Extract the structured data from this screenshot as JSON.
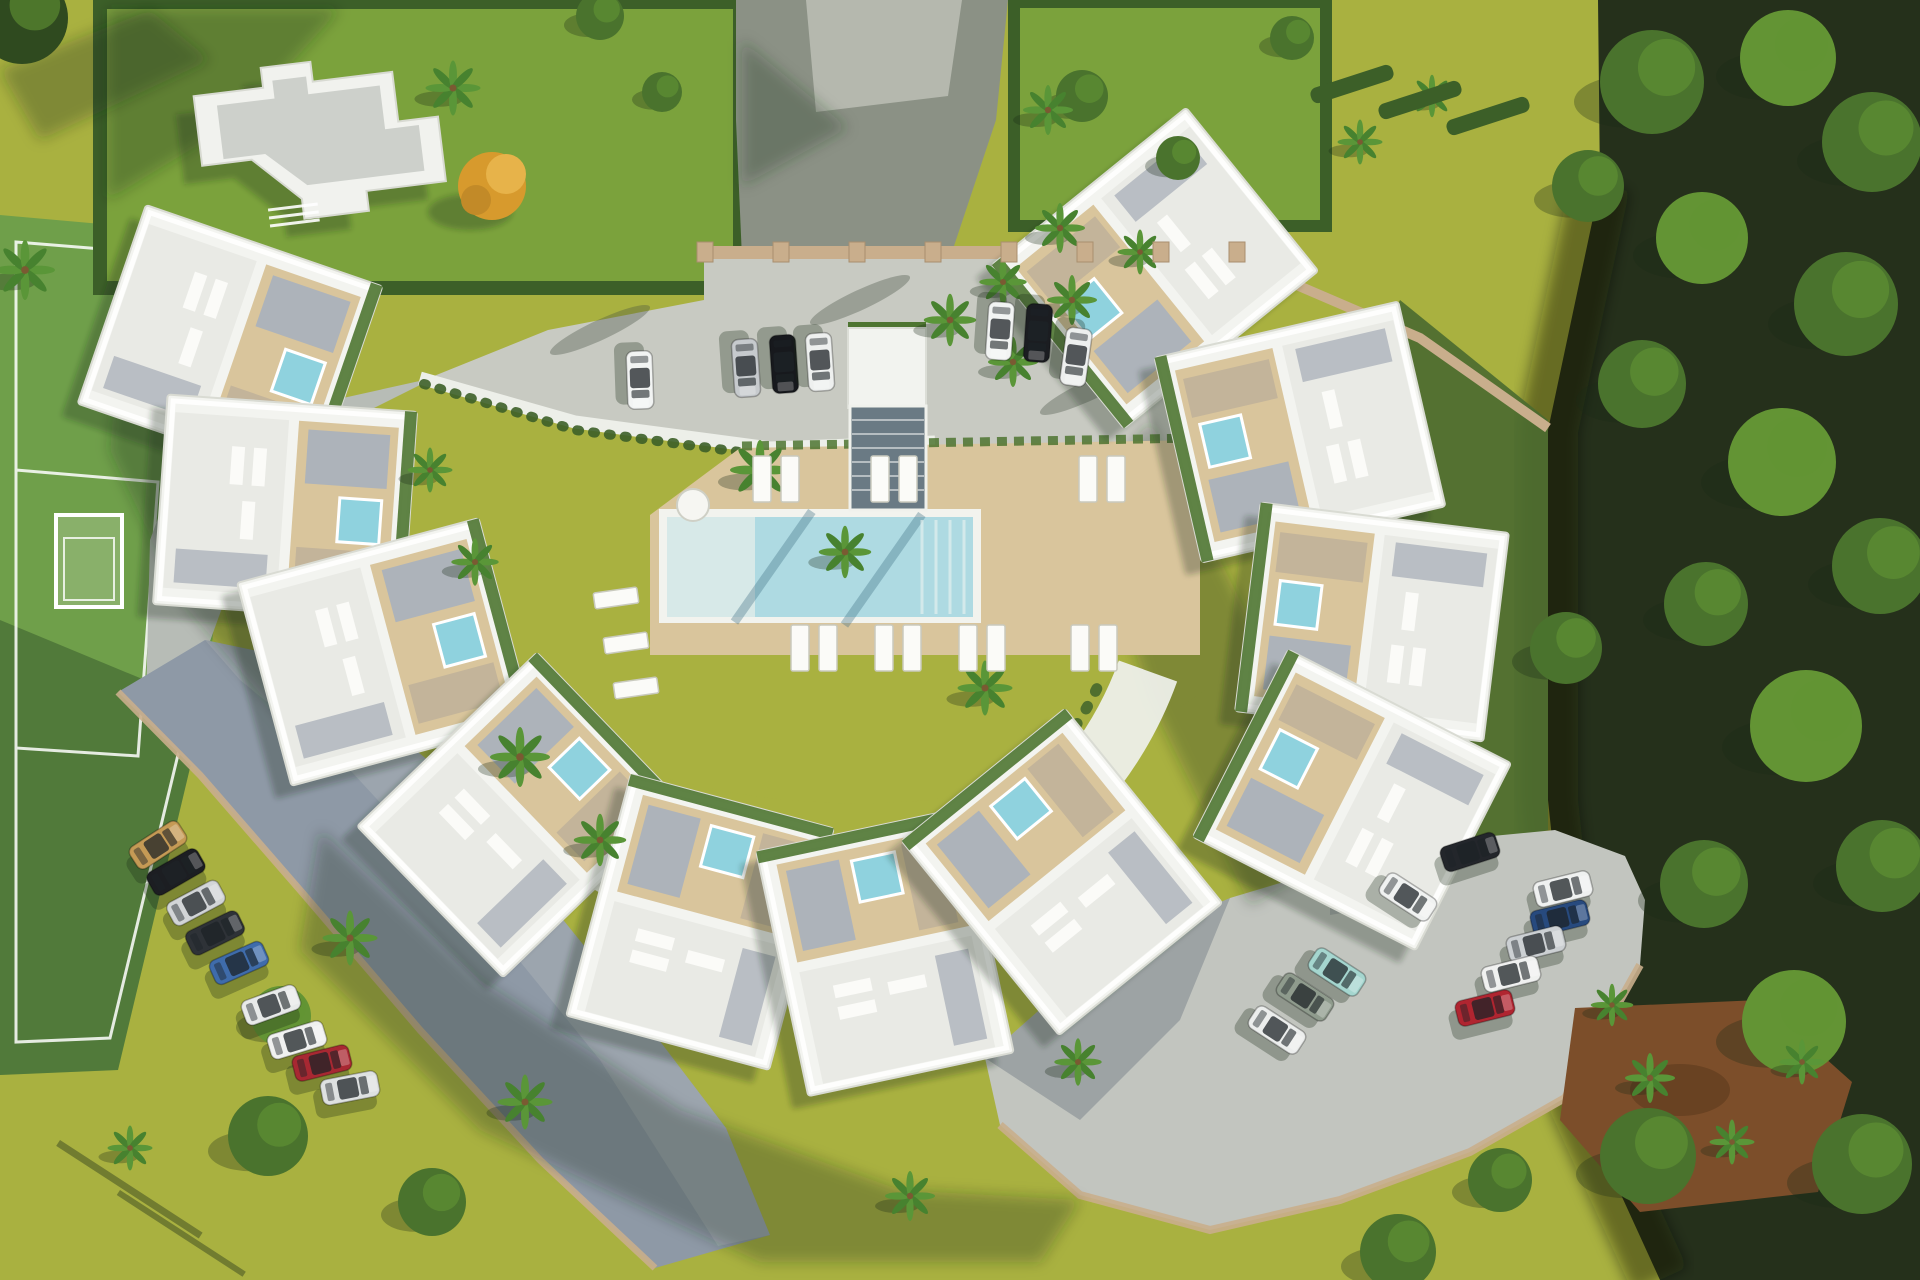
{
  "scene": {
    "description": "Aerial 3D architectural rendering of a crescent-shaped white apartment complex with rooftop terraces and plunge pools, a central lawn with rectangular swimming pool and timber sun deck, surrounding parking areas with cars, a green sports pitch on the left, a detached villa in a hedged garden at top-left, and dense dark woodland along the right side",
    "palette": {
      "grass": "#a9b140",
      "grass_bright": "#b8bf4e",
      "grass_dark": "#7ba23c",
      "pitch": "#6f9f4a",
      "hedge": "#3c5f28",
      "forest_bg": "#25301b",
      "forest_tree": "#4a732d",
      "forest_tree_light": "#639434",
      "forest_tree_dark": "#2f4a1f",
      "asphalt": "#8b9185",
      "concrete": "#c8cac2",
      "concrete_pad": "#b9bdb2",
      "concrete_lower": "#c2c5bf",
      "parking_shadow": "#8e99a6",
      "path": "#b7bcb6",
      "wall": "#c9ae8c",
      "building": "#f3f4f0",
      "roof_light": "#e9eae5",
      "roof_gray": "#cdd0cb",
      "deck": "#d9c59c",
      "gravel": "#adb3ba",
      "jacuzzi": "#8fd2de",
      "pool": "#aedae2",
      "pool_shallow": "#d7e9e8",
      "pool_rim": "#f2f3ee",
      "pergola": "#6a7a84",
      "dirt": "#7c4e2a",
      "mulch": "#8a4f2e",
      "lounger": "#fbfbf8",
      "shadow": "rgba(28,42,24,0.30)"
    },
    "units": [
      {
        "x": 230,
        "y": 345,
        "r": 109
      },
      {
        "x": 285,
        "y": 508,
        "r": 94
      },
      {
        "x": 385,
        "y": 652,
        "r": 75
      },
      {
        "x": 520,
        "y": 815,
        "r": 46
      },
      {
        "x": 700,
        "y": 922,
        "r": 15
      },
      {
        "x": 885,
        "y": 952,
        "r": -12
      },
      {
        "x": 1062,
        "y": 872,
        "r": -39
      },
      {
        "x": 1155,
        "y": 268,
        "r": -129
      },
      {
        "x": 1300,
        "y": 432,
        "r": -103
      },
      {
        "x": 1372,
        "y": 622,
        "r": -83
      },
      {
        "x": 1352,
        "y": 800,
        "r": -63
      }
    ],
    "cars": [
      {
        "x": 640,
        "y": 380,
        "a": 88,
        "c": "#f2f4f3"
      },
      {
        "x": 746,
        "y": 368,
        "a": 86,
        "c": "#c6cacd"
      },
      {
        "x": 784,
        "y": 364,
        "a": 86,
        "c": "#17191d"
      },
      {
        "x": 820,
        "y": 362,
        "a": 86,
        "c": "#eef0ef"
      },
      {
        "x": 1000,
        "y": 331,
        "a": 94,
        "c": "#f2f4f3"
      },
      {
        "x": 1038,
        "y": 333,
        "a": 94,
        "c": "#1b1d21"
      },
      {
        "x": 1076,
        "y": 357,
        "a": 98,
        "c": "#edefee"
      },
      {
        "x": 158,
        "y": 845,
        "a": -33,
        "c": "#c59a55"
      },
      {
        "x": 176,
        "y": 872,
        "a": -30,
        "c": "#1c1e22"
      },
      {
        "x": 196,
        "y": 903,
        "a": -28,
        "c": "#d2d5d7"
      },
      {
        "x": 215,
        "y": 933,
        "a": -26,
        "c": "#2e3237"
      },
      {
        "x": 239,
        "y": 963,
        "a": -24,
        "c": "#3f6cab"
      },
      {
        "x": 271,
        "y": 1005,
        "a": -20,
        "c": "#e8eae9"
      },
      {
        "x": 297,
        "y": 1040,
        "a": -17,
        "c": "#f0f1f0"
      },
      {
        "x": 322,
        "y": 1063,
        "a": -14,
        "c": "#a82832"
      },
      {
        "x": 350,
        "y": 1088,
        "a": -11,
        "c": "#dee1e1"
      },
      {
        "x": 1408,
        "y": 897,
        "a": 33,
        "c": "#f0f2f1"
      },
      {
        "x": 1337,
        "y": 972,
        "a": 33,
        "c": "#a5d6cf"
      },
      {
        "x": 1305,
        "y": 997,
        "a": 33,
        "c": "#8f9b8d"
      },
      {
        "x": 1277,
        "y": 1030,
        "a": 33,
        "c": "#eceeed"
      },
      {
        "x": 1470,
        "y": 852,
        "a": -18,
        "c": "#23262b"
      },
      {
        "x": 1563,
        "y": 889,
        "a": -14,
        "c": "#eff1f0"
      },
      {
        "x": 1560,
        "y": 918,
        "a": -14,
        "c": "#274a7e"
      },
      {
        "x": 1536,
        "y": 944,
        "a": -14,
        "c": "#ccd0d3"
      },
      {
        "x": 1511,
        "y": 974,
        "a": -14,
        "c": "#f0f1f0"
      },
      {
        "x": 1485,
        "y": 1008,
        "a": -14,
        "c": "#b02530"
      }
    ],
    "palms": [
      [
        453,
        88,
        1.1
      ],
      [
        25,
        270,
        1.2
      ],
      [
        1048,
        110,
        1.0
      ],
      [
        1060,
        228,
        1.0
      ],
      [
        1013,
        362,
        1.0
      ],
      [
        950,
        320,
        1.05
      ],
      [
        1003,
        282,
        0.95
      ],
      [
        1072,
        300,
        1.0
      ],
      [
        1140,
        252,
        0.9
      ],
      [
        760,
        470,
        1.2
      ],
      [
        845,
        552,
        1.05
      ],
      [
        985,
        688,
        1.1
      ],
      [
        520,
        757,
        1.2
      ],
      [
        600,
        840,
        1.05
      ],
      [
        475,
        562,
        0.95
      ],
      [
        430,
        470,
        0.9
      ],
      [
        350,
        938,
        1.1
      ],
      [
        525,
        1102,
        1.1
      ],
      [
        910,
        1196,
        1.0
      ],
      [
        1078,
        1062,
        0.95
      ],
      [
        1650,
        1078,
        1.0
      ],
      [
        1732,
        1142,
        0.9
      ],
      [
        1802,
        1062,
        0.9
      ],
      [
        1612,
        1005,
        0.85
      ],
      [
        1360,
        142,
        0.9
      ],
      [
        1432,
        96,
        0.85
      ],
      [
        130,
        1148,
        0.9
      ]
    ],
    "trees": [
      [
        22,
        18,
        46,
        2
      ],
      [
        600,
        16,
        24,
        0
      ],
      [
        662,
        92,
        20,
        0
      ],
      [
        1082,
        96,
        26,
        0
      ],
      [
        1178,
        158,
        22,
        0
      ],
      [
        1292,
        38,
        22,
        0
      ],
      [
        281,
        1016,
        30,
        1
      ],
      [
        268,
        1136,
        40,
        0
      ],
      [
        432,
        1202,
        34,
        0
      ],
      [
        1652,
        82,
        52,
        0
      ],
      [
        1788,
        58,
        48,
        1
      ],
      [
        1872,
        142,
        50,
        0
      ],
      [
        1702,
        238,
        46,
        1
      ],
      [
        1846,
        304,
        52,
        0
      ],
      [
        1642,
        384,
        44,
        0
      ],
      [
        1782,
        462,
        54,
        1
      ],
      [
        1880,
        566,
        48,
        0
      ],
      [
        1706,
        604,
        42,
        0
      ],
      [
        1806,
        726,
        56,
        1
      ],
      [
        1882,
        866,
        46,
        0
      ],
      [
        1704,
        884,
        44,
        0
      ],
      [
        1794,
        1022,
        52,
        1
      ],
      [
        1648,
        1156,
        48,
        0
      ],
      [
        1862,
        1164,
        50,
        0
      ],
      [
        1588,
        186,
        36,
        0
      ],
      [
        1566,
        648,
        36,
        0
      ],
      [
        1398,
        1252,
        38,
        0
      ],
      [
        1500,
        1180,
        32,
        0
      ]
    ],
    "hedgerows": [
      [
        1352,
        84
      ],
      [
        1420,
        100
      ],
      [
        1488,
        116
      ]
    ],
    "pillars": [
      705,
      781,
      857,
      933,
      1009,
      1085,
      1161,
      1237
    ],
    "loungers": {
      "deck_top": {
        "y": 456,
        "xs": [
          762,
          790,
          880,
          908,
          1088,
          1116
        ],
        "w": 18,
        "h": 46
      },
      "deck_bottom": {
        "y": 625,
        "xs": [
          800,
          828,
          884,
          912,
          968,
          996,
          1080,
          1108
        ],
        "w": 18,
        "h": 46
      },
      "lawn": {
        "items": [
          [
            616,
            598
          ],
          [
            626,
            643
          ],
          [
            636,
            688
          ]
        ],
        "w": 44,
        "h": 16,
        "rot": -8
      }
    },
    "table": {
      "x": 693,
      "y": 505,
      "r": 16
    }
  }
}
